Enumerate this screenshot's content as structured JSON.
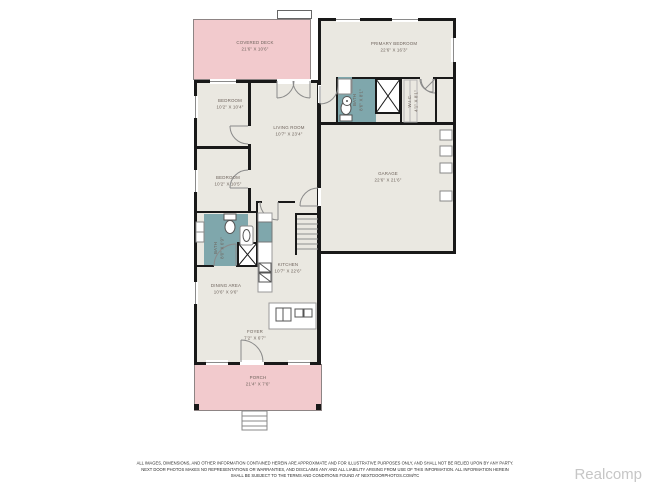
{
  "plan": {
    "rooms": [
      {
        "id": "covered-deck",
        "name": "COVERED DECK",
        "dims": "21'6\" X 10'6\""
      },
      {
        "id": "primary-bedroom",
        "name": "PRIMARY BEDROOM",
        "dims": "22'6\" X 16'3\""
      },
      {
        "id": "bedroom-1",
        "name": "BEDROOM",
        "dims": "10'2\" X 10'4\""
      },
      {
        "id": "living-room",
        "name": "LIVING ROOM",
        "dims": "10'7\" X 23'4\""
      },
      {
        "id": "primary-bath",
        "name": "BATH",
        "dims": "8'6\" X 8'1\""
      },
      {
        "id": "walk-in-closet",
        "name": "W.I.C.",
        "dims": "4'1\" X 8'1\""
      },
      {
        "id": "garage",
        "name": "GARAGE",
        "dims": "22'6\" X 21'6\""
      },
      {
        "id": "bedroom-2",
        "name": "BEDROOM",
        "dims": "10'2\" X 10'5\""
      },
      {
        "id": "bath",
        "name": "BATH",
        "dims": "8'0\" X 6'9\""
      },
      {
        "id": "kitchen",
        "name": "KITCHEN",
        "dims": "10'7\" X 22'6\""
      },
      {
        "id": "dining-area",
        "name": "DINING AREA",
        "dims": "10'6\" X 9'6\""
      },
      {
        "id": "foyer",
        "name": "FOYER",
        "dims": "7'2\" X 6'7\""
      },
      {
        "id": "porch",
        "name": "PORCH",
        "dims": "21'4\" X 7'6\""
      }
    ]
  },
  "footer": {
    "disclaimer_line1": "ALL IMAGES, DIMENSIONS, AND OTHER INFORMATION CONTAINED HEREIN ARE APPROXIMATE AND FOR ILLUSTRATIVE PURPOSES ONLY, AND SHALL NOT BE RELIED UPON BY ANY PARTY.",
    "disclaimer_line2": "NEXT DOOR PHOTOS MAKES NO REPRESENTATIONS OR WARRANTIES, AND DISCLAIMS ANY AND ALL LIABILITY ARISING FROM USE OF THIS INFORMATION. ALL INFORMATION HEREIN",
    "disclaimer_line3": "SHALL BE SUBJECT TO THE TERMS AND CONDITIONS FOUND AT NEXTDOORPHOTOS.COM/TC",
    "watermark": "Realcomp"
  },
  "colors": {
    "deck_pink": "#f2cacd",
    "bath_teal": "#7fa7ac",
    "floor": "#eae8e1",
    "wall": "#191919",
    "label_text": "#6e635c",
    "watermark_gray": "#c6c6c6"
  }
}
